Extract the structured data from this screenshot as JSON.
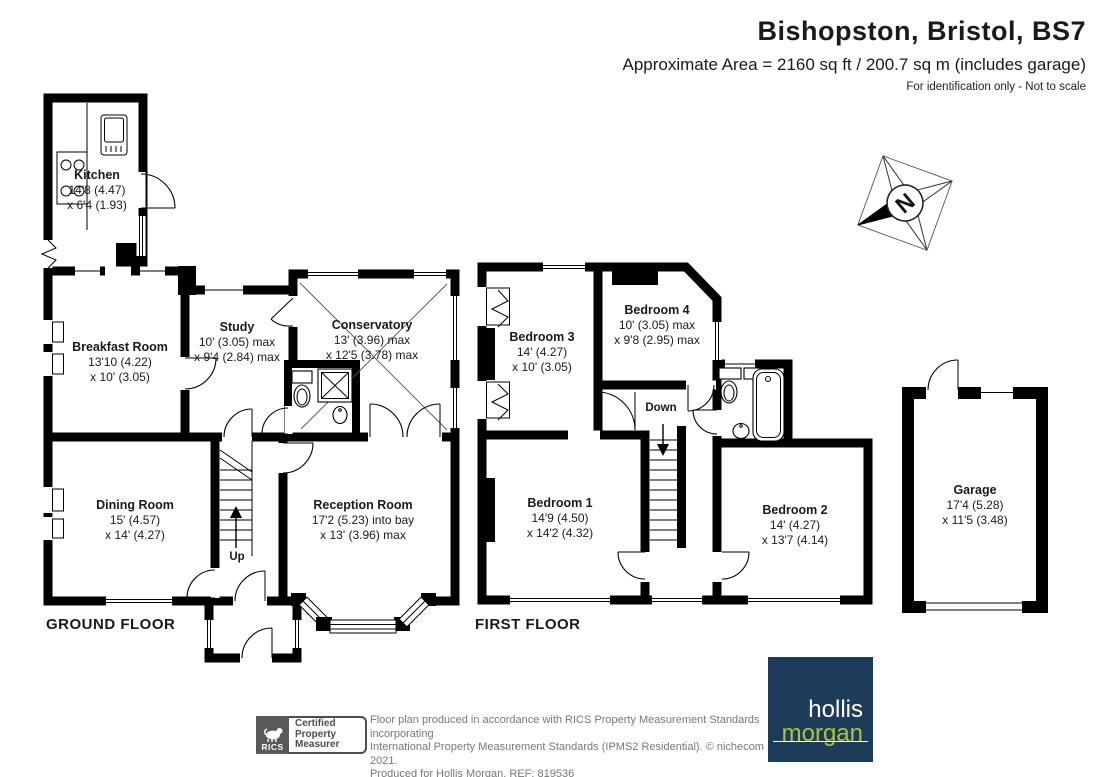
{
  "header": {
    "title": "Bishopston, Bristol, BS7",
    "subtitle": "Approximate Area = 2160 sq ft / 200.7 sq m (includes garage)",
    "disclaimer": "For identification only - Not to scale"
  },
  "floors": {
    "ground": "GROUND FLOOR",
    "first": "FIRST FLOOR"
  },
  "rooms": {
    "kitchen": {
      "name": "Kitchen",
      "d1": "14'8 (4.47)",
      "d2": "x 6'4 (1.93)"
    },
    "breakfast": {
      "name": "Breakfast Room",
      "d1": "13'10 (4.22)",
      "d2": "x 10' (3.05)"
    },
    "study": {
      "name": "Study",
      "d1": "10' (3.05) max",
      "d2": "x 9'4 (2.84) max"
    },
    "conservatory": {
      "name": "Conservatory",
      "d1": "13' (3.96) max",
      "d2": "x 12'5 (3.78) max"
    },
    "dining": {
      "name": "Dining Room",
      "d1": "15' (4.57)",
      "d2": "x 14' (4.27)"
    },
    "reception": {
      "name": "Reception Room",
      "d1": "17'2 (5.23) into bay",
      "d2": "x 13' (3.96) max"
    },
    "bedroom1": {
      "name": "Bedroom 1",
      "d1": "14'9 (4.50)",
      "d2": "x 14'2 (4.32)"
    },
    "bedroom2": {
      "name": "Bedroom 2",
      "d1": "14' (4.27)",
      "d2": "x 13'7 (4.14)"
    },
    "bedroom3": {
      "name": "Bedroom 3",
      "d1": "14' (4.27)",
      "d2": "x 10' (3.05)"
    },
    "bedroom4": {
      "name": "Bedroom 4",
      "d1": "10' (3.05) max",
      "d2": "x 9'8 (2.95) max"
    },
    "garage": {
      "name": "Garage",
      "d1": "17'4 (5.28)",
      "d2": "x 11'5 (3.48)"
    }
  },
  "stairs": {
    "up": "Up",
    "down": "Down"
  },
  "compass": {
    "letter": "N"
  },
  "footer": {
    "line1": "Floor plan produced in accordance with RICS Property Measurement Standards incorporating",
    "line2": "International Property Measurement Standards (IPMS2 Residential).   © nichecom 2021.",
    "line3": "Produced for Hollis Morgan.    REF:  819536",
    "rics": {
      "brand": "RICS",
      "cert1": "Certified",
      "cert2": "Property",
      "cert3": "Measurer"
    },
    "logo": {
      "top": "hollis",
      "bottom": "morgan"
    }
  },
  "colors": {
    "navy": "#1d3c5a",
    "green": "#a8c43f",
    "gray": "#58595b",
    "wall": "#000000"
  }
}
